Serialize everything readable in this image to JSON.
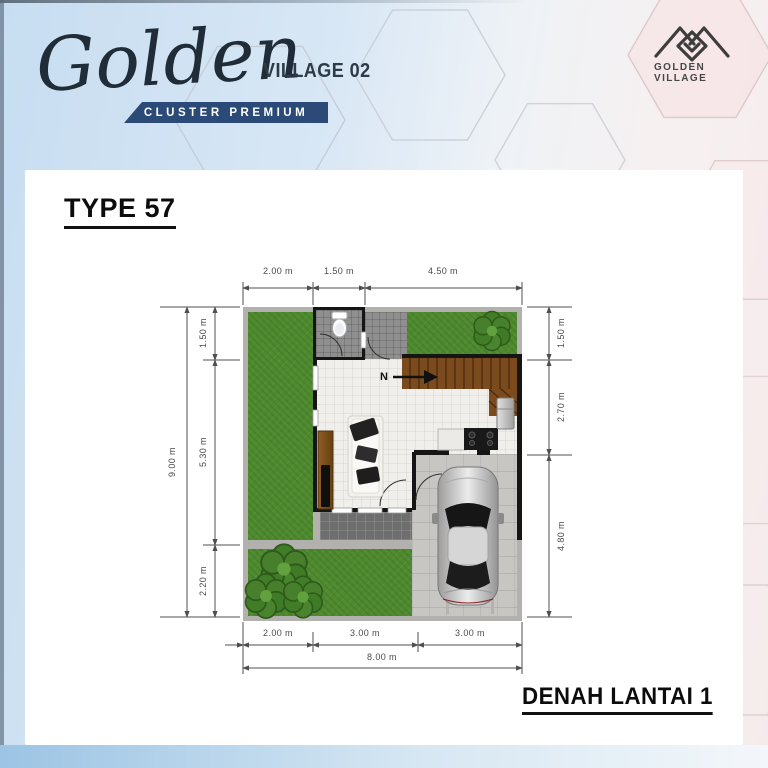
{
  "header": {
    "brand_script": "Golden",
    "brand_suffix": "VILLAGE 02",
    "banner_label": "CLUSTER PREMIUM",
    "logo_text": "GOLDEN VILLAGE"
  },
  "floorplan": {
    "type_title": "TYPE 57",
    "caption": "DENAH LANTAI 1",
    "north_label": "N",
    "dims": {
      "top": [
        "2.00 m",
        "1.50 m",
        "4.50 m"
      ],
      "left_total": "9.00 m",
      "left_segments": [
        "1.50 m",
        "5.30 m",
        "2.20 m"
      ],
      "right_segments": [
        "1.50 m",
        "2.70 m",
        "4.80 m"
      ],
      "bottom_segments": [
        "2.00 m",
        "3.00 m",
        "3.00 m"
      ],
      "bottom_total": "8.00 m"
    },
    "colors": {
      "banner_navy": "#2c4a78",
      "grass_green": "#4e8a2e",
      "wall_black": "#151515",
      "stairs_wood": "#7b4b1d",
      "carport_concrete": "#c7c6c3"
    }
  }
}
